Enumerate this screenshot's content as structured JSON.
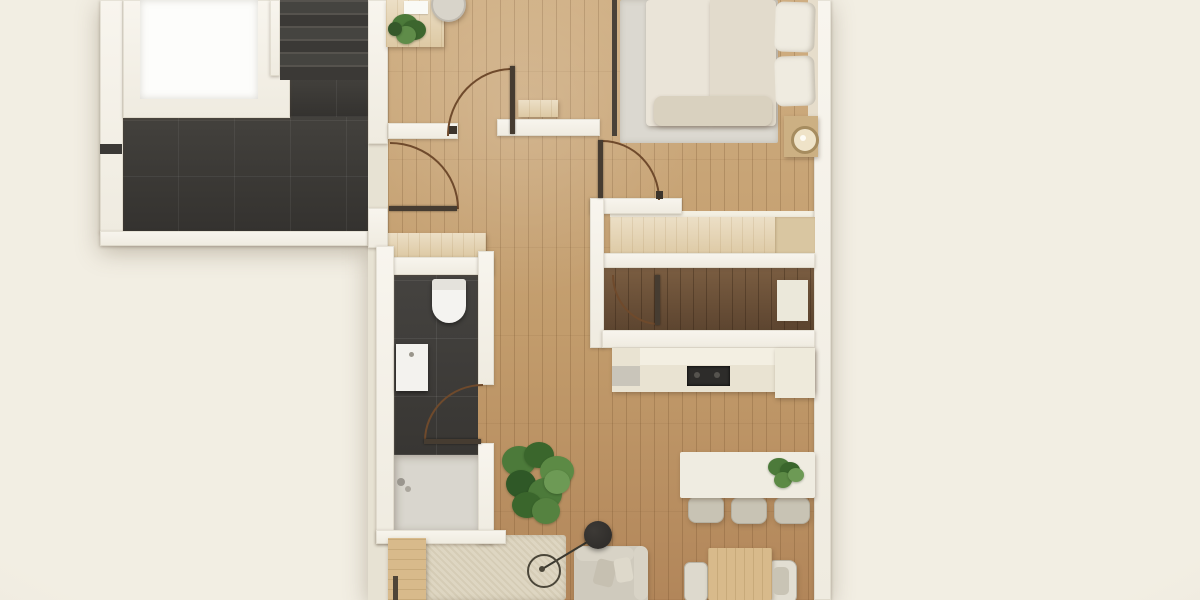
{
  "scene": {
    "type": "floor-plan-render",
    "view": "top-down",
    "subject": "apartment with stair landing, entry hall, bedroom, dressing room, kitchen, bathroom and living-dining area"
  },
  "colors": {
    "bg": "#f2eee3",
    "wallFace": "#f8f5ee",
    "voidWhite": "#fdfdfb",
    "tile": "#3e3c39",
    "woodBase": "#c29c6c",
    "woodHi": "#cfae82",
    "woodLo": "#b2865a",
    "walnut": "#6e5339",
    "lightWood": "#e6d6b8",
    "lightWood2": "#d8ba8b",
    "counterCream": "#e9e3d2",
    "counterWhite": "#f3efe2",
    "cooktop": "#2d2c2a",
    "bedding": "#eae4d8",
    "pillow": "#efebe0",
    "rugBedroom": "#dbd8d0",
    "rugLiving": "#ded6c2",
    "sofa": "#cfcabd",
    "tub": "#d9d6ce",
    "cabinetWhite": "#ebe8da",
    "stoolGray": "#d8d4ca",
    "greenDark": "#35582a",
    "greenMid": "#4c7a3a",
    "greenLight": "#6d9a55",
    "arc": "#6f4a2c",
    "leaf": "#463c31",
    "lampBlack": "#2b2927"
  },
  "rooms": [
    {
      "name": "stair-landing",
      "floor": "dark-tile"
    },
    {
      "name": "staircase",
      "floor": "dark-steps"
    },
    {
      "name": "stairwell-void",
      "floor": "white-void"
    },
    {
      "name": "entry-hall",
      "floor": "oak-plank"
    },
    {
      "name": "bedroom",
      "floor": "oak-plank"
    },
    {
      "name": "dressing-room",
      "floor": "walnut-plank"
    },
    {
      "name": "kitchen",
      "floor": "oak-plank"
    },
    {
      "name": "bathroom",
      "floor": "dark-tile"
    },
    {
      "name": "living-dining-area",
      "floor": "oak-plank"
    }
  ],
  "furniture": [
    "console-table",
    "console-plant",
    "entry-stool",
    "wall-shelf",
    "double-bed",
    "pillows",
    "bedroom-rug",
    "nightstand",
    "table-lamp",
    "wardrobe",
    "desk-cabinet",
    "kitchen-counter",
    "cooktop",
    "toilet",
    "sink-vanity",
    "bathtub-shower",
    "dining-table",
    "dining-chairs",
    "dining-table-plant",
    "wood-side-table",
    "armchair-left",
    "armchair-right",
    "sofa",
    "sofa-pillows",
    "living-rug",
    "floor-lamp",
    "large-floor-plant",
    "sideboard"
  ],
  "doors": [
    {
      "name": "apartment-entry-door"
    },
    {
      "name": "hall-door"
    },
    {
      "name": "bedroom-door"
    },
    {
      "name": "dressing-room-door"
    },
    {
      "name": "bathroom-door"
    }
  ]
}
